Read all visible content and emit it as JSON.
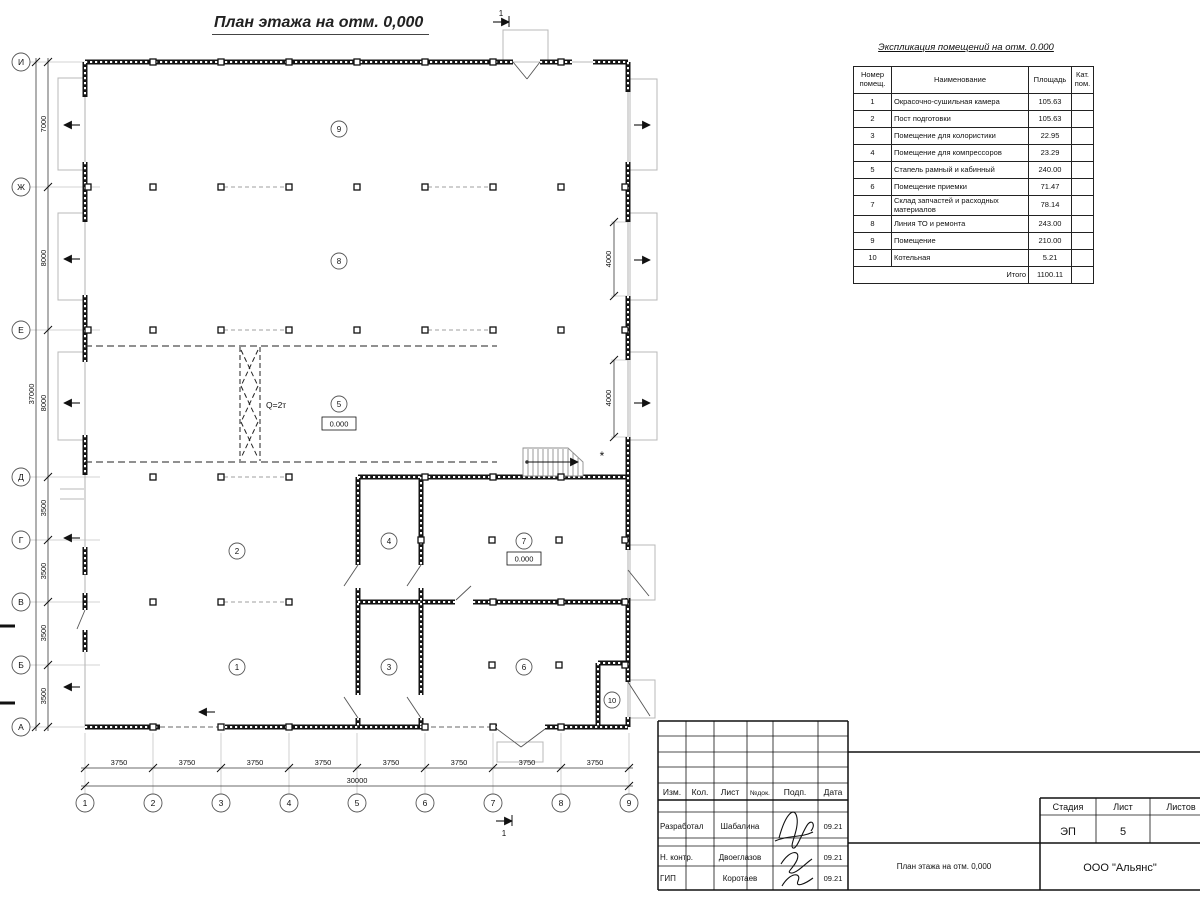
{
  "plan": {
    "title": "План этажа на отм. 0,000",
    "crane_label": "Q=2т",
    "asterisk": "*",
    "level_marks": [
      "0.000",
      "0.000"
    ],
    "section_marks": [
      "1",
      "1"
    ],
    "rooms": [
      "9",
      "8",
      "5",
      "2",
      "4",
      "7",
      "1",
      "3",
      "6",
      "10"
    ],
    "axes_rows": [
      "И",
      "Ж",
      "Е",
      "Д",
      "Г",
      "В",
      "Б",
      "А"
    ],
    "axes_cols": [
      "1",
      "2",
      "3",
      "4",
      "5",
      "6",
      "7",
      "8",
      "9"
    ],
    "dims": {
      "left": [
        "7000",
        "8000",
        "8000",
        "3500",
        "3500",
        "3500",
        "3500"
      ],
      "left_total": "37000",
      "bottom": [
        "3750",
        "3750",
        "3750",
        "3750",
        "3750",
        "3750",
        "3750",
        "3750"
      ],
      "bottom_total": "30000",
      "gates": [
        "4000",
        "4000"
      ]
    }
  },
  "explication": {
    "title": "Экспликация помещений на отм. 0.000",
    "headers": [
      "Номер помещ.",
      "Наименование",
      "Площадь",
      "Кат. пом."
    ],
    "rows": [
      {
        "n": "1",
        "name": "Окрасочно-сушильная камера",
        "area": "105.63",
        "cat": ""
      },
      {
        "n": "2",
        "name": "Пост подготовки",
        "area": "105.63",
        "cat": ""
      },
      {
        "n": "3",
        "name": "Помещение для колористики",
        "area": "22.95",
        "cat": ""
      },
      {
        "n": "4",
        "name": "Помещение для компрессоров",
        "area": "23.29",
        "cat": ""
      },
      {
        "n": "5",
        "name": "Стапель рамный и кабинный",
        "area": "240.00",
        "cat": ""
      },
      {
        "n": "6",
        "name": "Помещение приемки",
        "area": "71.47",
        "cat": ""
      },
      {
        "n": "7",
        "name": "Склад запчастей и расходных материалов",
        "area": "78.14",
        "cat": ""
      },
      {
        "n": "8",
        "name": "Линия ТО и ремонта",
        "area": "243.00",
        "cat": ""
      },
      {
        "n": "9",
        "name": "Помещение",
        "area": "210.00",
        "cat": ""
      },
      {
        "n": "10",
        "name": "Котельная",
        "area": "5.21",
        "cat": ""
      }
    ],
    "total_label": "Итого",
    "total_value": "1100.11"
  },
  "title_block": {
    "cols": [
      "Изм.",
      "Кол.",
      "Лист",
      "№док.",
      "Подп.",
      "Дата"
    ],
    "rows": [
      {
        "role": "Разработал",
        "name": "Шабалина",
        "date": "09.21"
      },
      {
        "role": "Н. контр.",
        "name": "Двоеглазов",
        "date": "09.21"
      },
      {
        "role": "ГИП",
        "name": "Коротаев",
        "date": "09.21"
      }
    ],
    "stage_label": "Стадия",
    "sheet_label": "Лист",
    "sheets_label": "Листов",
    "stage_value": "ЭП",
    "sheet_value": "5",
    "doc_title": "План этажа на отм. 0,000",
    "company": "ООО \"Альянс\""
  },
  "colors": {
    "line": "#141414",
    "light": "#b8b8b8",
    "paper": "#ffffff"
  }
}
